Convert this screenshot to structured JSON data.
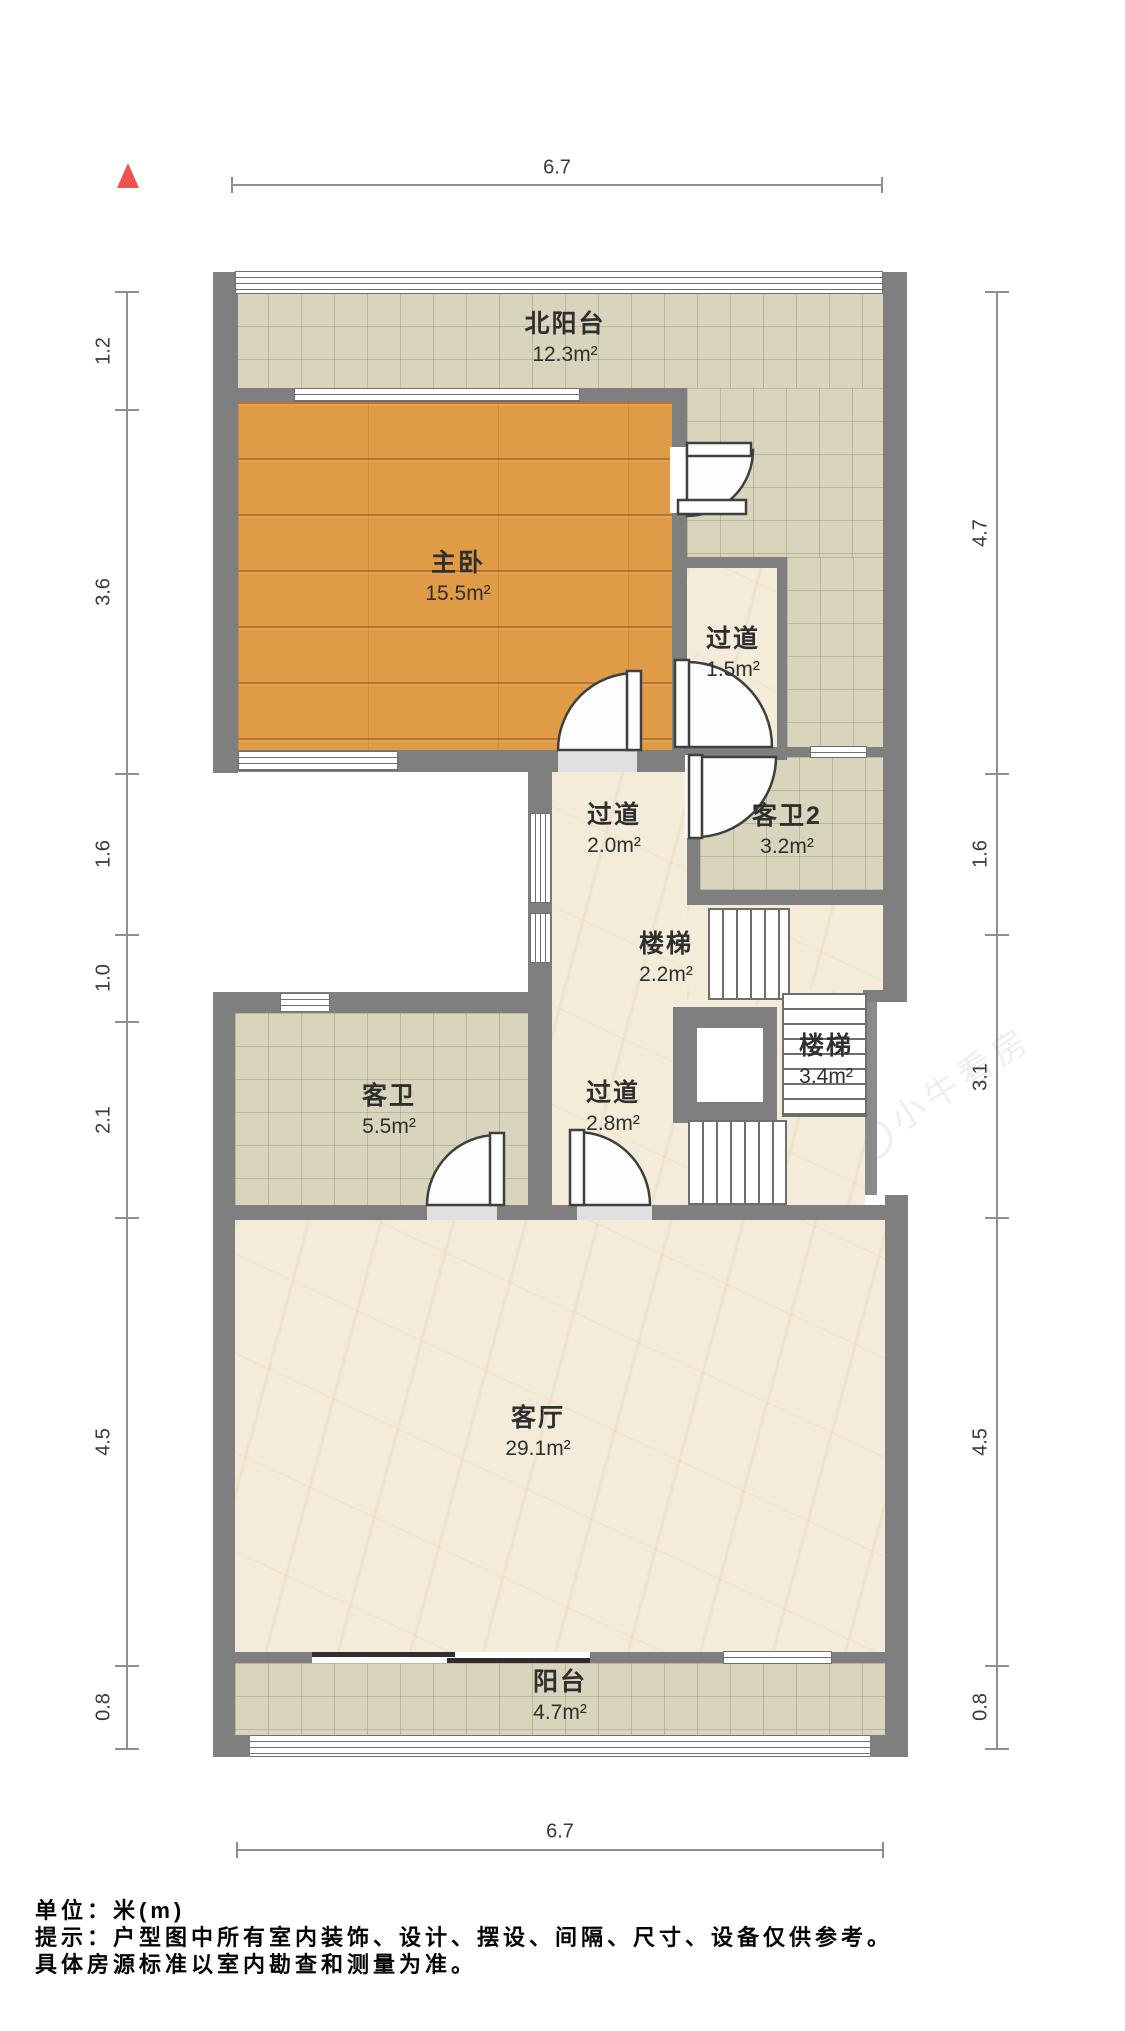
{
  "rooms": [
    {
      "id": "north-balcony",
      "name": "北阳台",
      "area": "12.3m²"
    },
    {
      "id": "master-bedroom",
      "name": "主卧",
      "area": "15.5m²"
    },
    {
      "id": "hallway-1",
      "name": "过道",
      "area": "1.5m²"
    },
    {
      "id": "hallway-2",
      "name": "过道",
      "area": "2.0m²"
    },
    {
      "id": "guest-bath-2",
      "name": "客卫2",
      "area": "3.2m²"
    },
    {
      "id": "stairs-1",
      "name": "楼梯",
      "area": "2.2m²"
    },
    {
      "id": "stairs-2",
      "name": "楼梯",
      "area": "3.4m²"
    },
    {
      "id": "guest-bath",
      "name": "客卫",
      "area": "5.5m²"
    },
    {
      "id": "hallway-3",
      "name": "过道",
      "area": "2.8m²"
    },
    {
      "id": "living-room",
      "name": "客厅",
      "area": "29.1m²"
    },
    {
      "id": "balcony",
      "name": "阳台",
      "area": "4.7m²"
    }
  ],
  "dimensions": {
    "top": "6.7",
    "bottom": "6.7",
    "left": [
      "1.2",
      "3.6",
      "1.6",
      "1.0",
      "2.1",
      "4.5",
      "0.8"
    ],
    "right": [
      "4.7",
      "1.6",
      "3.1",
      "4.5",
      "0.8"
    ]
  },
  "footer": {
    "line1": "单位：米(m)",
    "line2": "提示：户型图中所有室内装饰、设计、摆设、间隔、尺寸、设备仅供参考。",
    "line3": "具体房源标准以室内勘查和测量为准。"
  },
  "watermark": "小牛看房",
  "colors": {
    "wall": "#7f7f7f",
    "wood_floor": "#df9b45",
    "tile_floor": "#d9d5bc",
    "marble_floor": "#f4ecd8",
    "north_arrow": "#ef5350"
  }
}
